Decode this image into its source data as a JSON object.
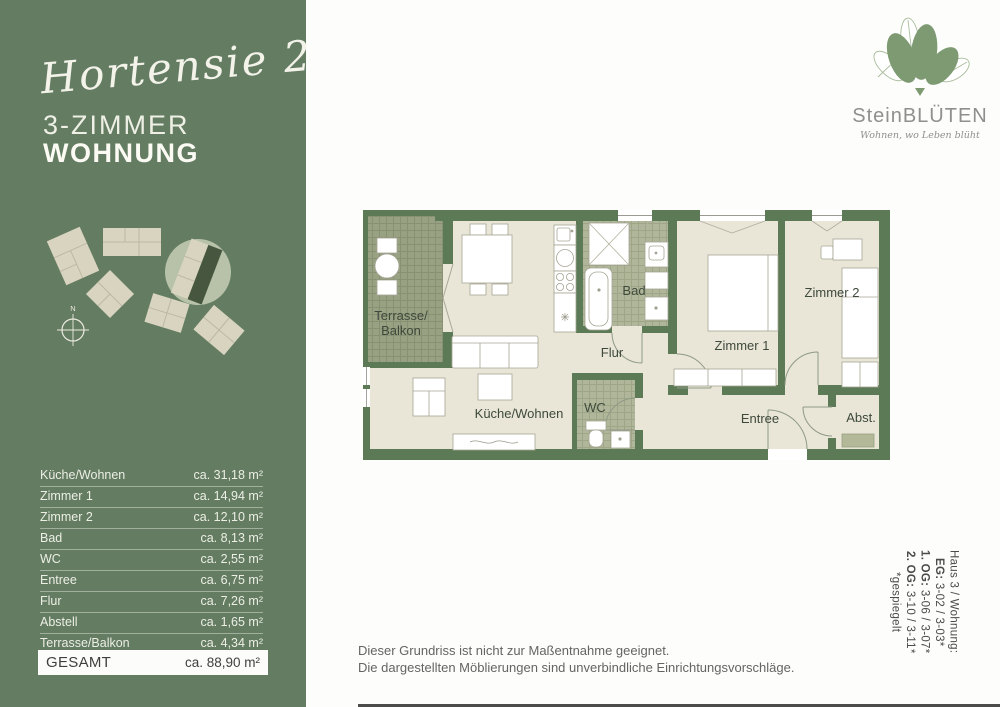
{
  "sidebar": {
    "title_script": "Hortensie 2",
    "title_line1": "3-ZIMMER",
    "title_line2": "WOHNUNG",
    "compass_label": "N",
    "table": {
      "rows": [
        {
          "label": "Küche/Wohnen",
          "value": "ca. 31,18 m²"
        },
        {
          "label": "Zimmer 1",
          "value": "ca. 14,94 m²"
        },
        {
          "label": "Zimmer 2",
          "value": "ca. 12,10 m²"
        },
        {
          "label": "Bad",
          "value": "ca. 8,13 m²"
        },
        {
          "label": "WC",
          "value": "ca. 2,55 m²"
        },
        {
          "label": "Entree",
          "value": "ca. 6,75 m²"
        },
        {
          "label": "Flur",
          "value": "ca. 7,26 m²"
        },
        {
          "label": "Abstell",
          "value": "ca. 1,65 m²"
        },
        {
          "label": "Terrasse/Balkon",
          "value": "ca. 4,34 m²"
        }
      ],
      "total": {
        "label": "GESAMT",
        "value": "ca. 88,90 m²"
      }
    }
  },
  "logo": {
    "name": "SteinBLÜTEN",
    "tagline": "Wohnen, wo Leben blüht"
  },
  "plan": {
    "labels": {
      "terrasse_line1": "Terrasse/",
      "terrasse_line2": "Balkon",
      "kueche_wohnen": "Küche/Wohnen",
      "bad": "Bad",
      "flur": "Flur",
      "wc": "WC",
      "zimmer1": "Zimmer 1",
      "zimmer2": "Zimmer 2",
      "entree": "Entree",
      "abstell": "Abst."
    }
  },
  "info": {
    "haus": "Haus 3 / Wohnung:",
    "eg_label": "EG:",
    "eg": "3-02 / 3-03*",
    "og1_label": "1. OG:",
    "og1": "3-06 / 3-07*",
    "og2_label": "2. OG:",
    "og2": "3-10 / 3-11*",
    "mirror": "*gespiegelt"
  },
  "disclaimer": {
    "line1": "Dieser Grundriss ist nicht zur Maßentnahme geeignet.",
    "line2": "Die dargestellten Möblierungen sind unverbindliche Einrichtungsvorschläge."
  },
  "colors": {
    "sidebar_green": "#637c62",
    "wall_green": "#5c7a55",
    "floor_cream": "#e9e6d8",
    "terrace_hatch": "#99a183",
    "bath_hatch": "#b0b69a",
    "highlight_dark": "#47573f",
    "logo_leaf_green": "#7e9a72",
    "label_dark": "#3d493b"
  }
}
